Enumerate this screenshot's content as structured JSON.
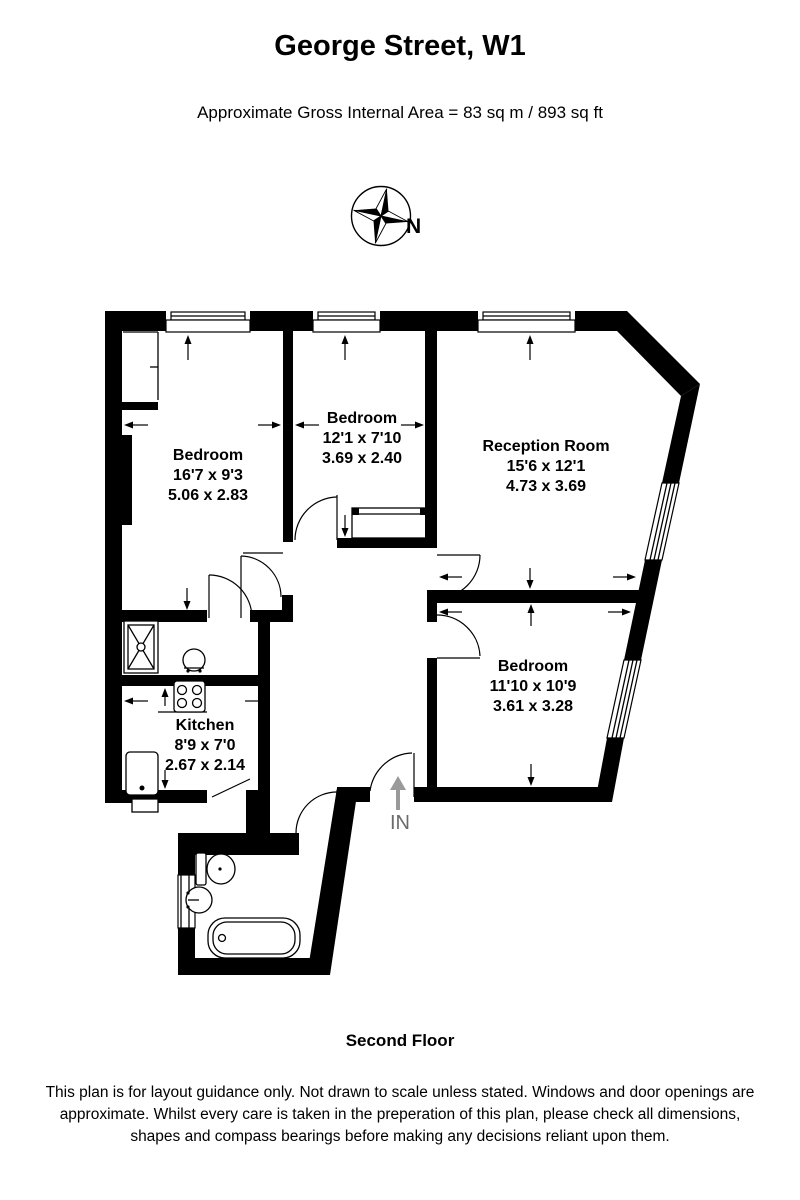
{
  "header": {
    "title": "George Street, W1",
    "subtitle": "Approximate Gross Internal Area = 83 sq m / 893 sq ft"
  },
  "compass": {
    "label": "N"
  },
  "plan": {
    "entrance_label": "IN",
    "rooms": [
      {
        "name": "Bedroom",
        "imperial": "16'7 x 9'3",
        "metric": "5.06 x 2.83"
      },
      {
        "name": "Bedroom",
        "imperial": "12'1 x 7'10",
        "metric": "3.69 x 2.40"
      },
      {
        "name": "Reception Room",
        "imperial": "15'6 x 12'1",
        "metric": "4.73 x 3.69"
      },
      {
        "name": "Bedroom",
        "imperial": "11'10 x 10'9",
        "metric": "3.61 x 3.28"
      },
      {
        "name": "Kitchen",
        "imperial": "8'9 x 7'0",
        "metric": "2.67 x 2.14"
      }
    ],
    "fixture_icons": [
      "shower-icon",
      "toilet-icon",
      "basin-icon",
      "bathtub-icon",
      "hob-icon",
      "sink-icon"
    ]
  },
  "footer": {
    "floor_label": "Second Floor",
    "disclaimer_line1": "This plan is for layout guidance only. Not drawn to scale unless stated. Windows and door openings are",
    "disclaimer_line2": "approximate. Whilst every care is taken in the preperation of this plan, please check all dimensions,",
    "disclaimer_line3": "shapes and compass bearings before making any decisions reliant upon them."
  },
  "colors": {
    "wall": "#000000",
    "background": "#ffffff",
    "entrance_arrow": "#9a9a9a",
    "entrance_text": "#6b6b6b"
  }
}
